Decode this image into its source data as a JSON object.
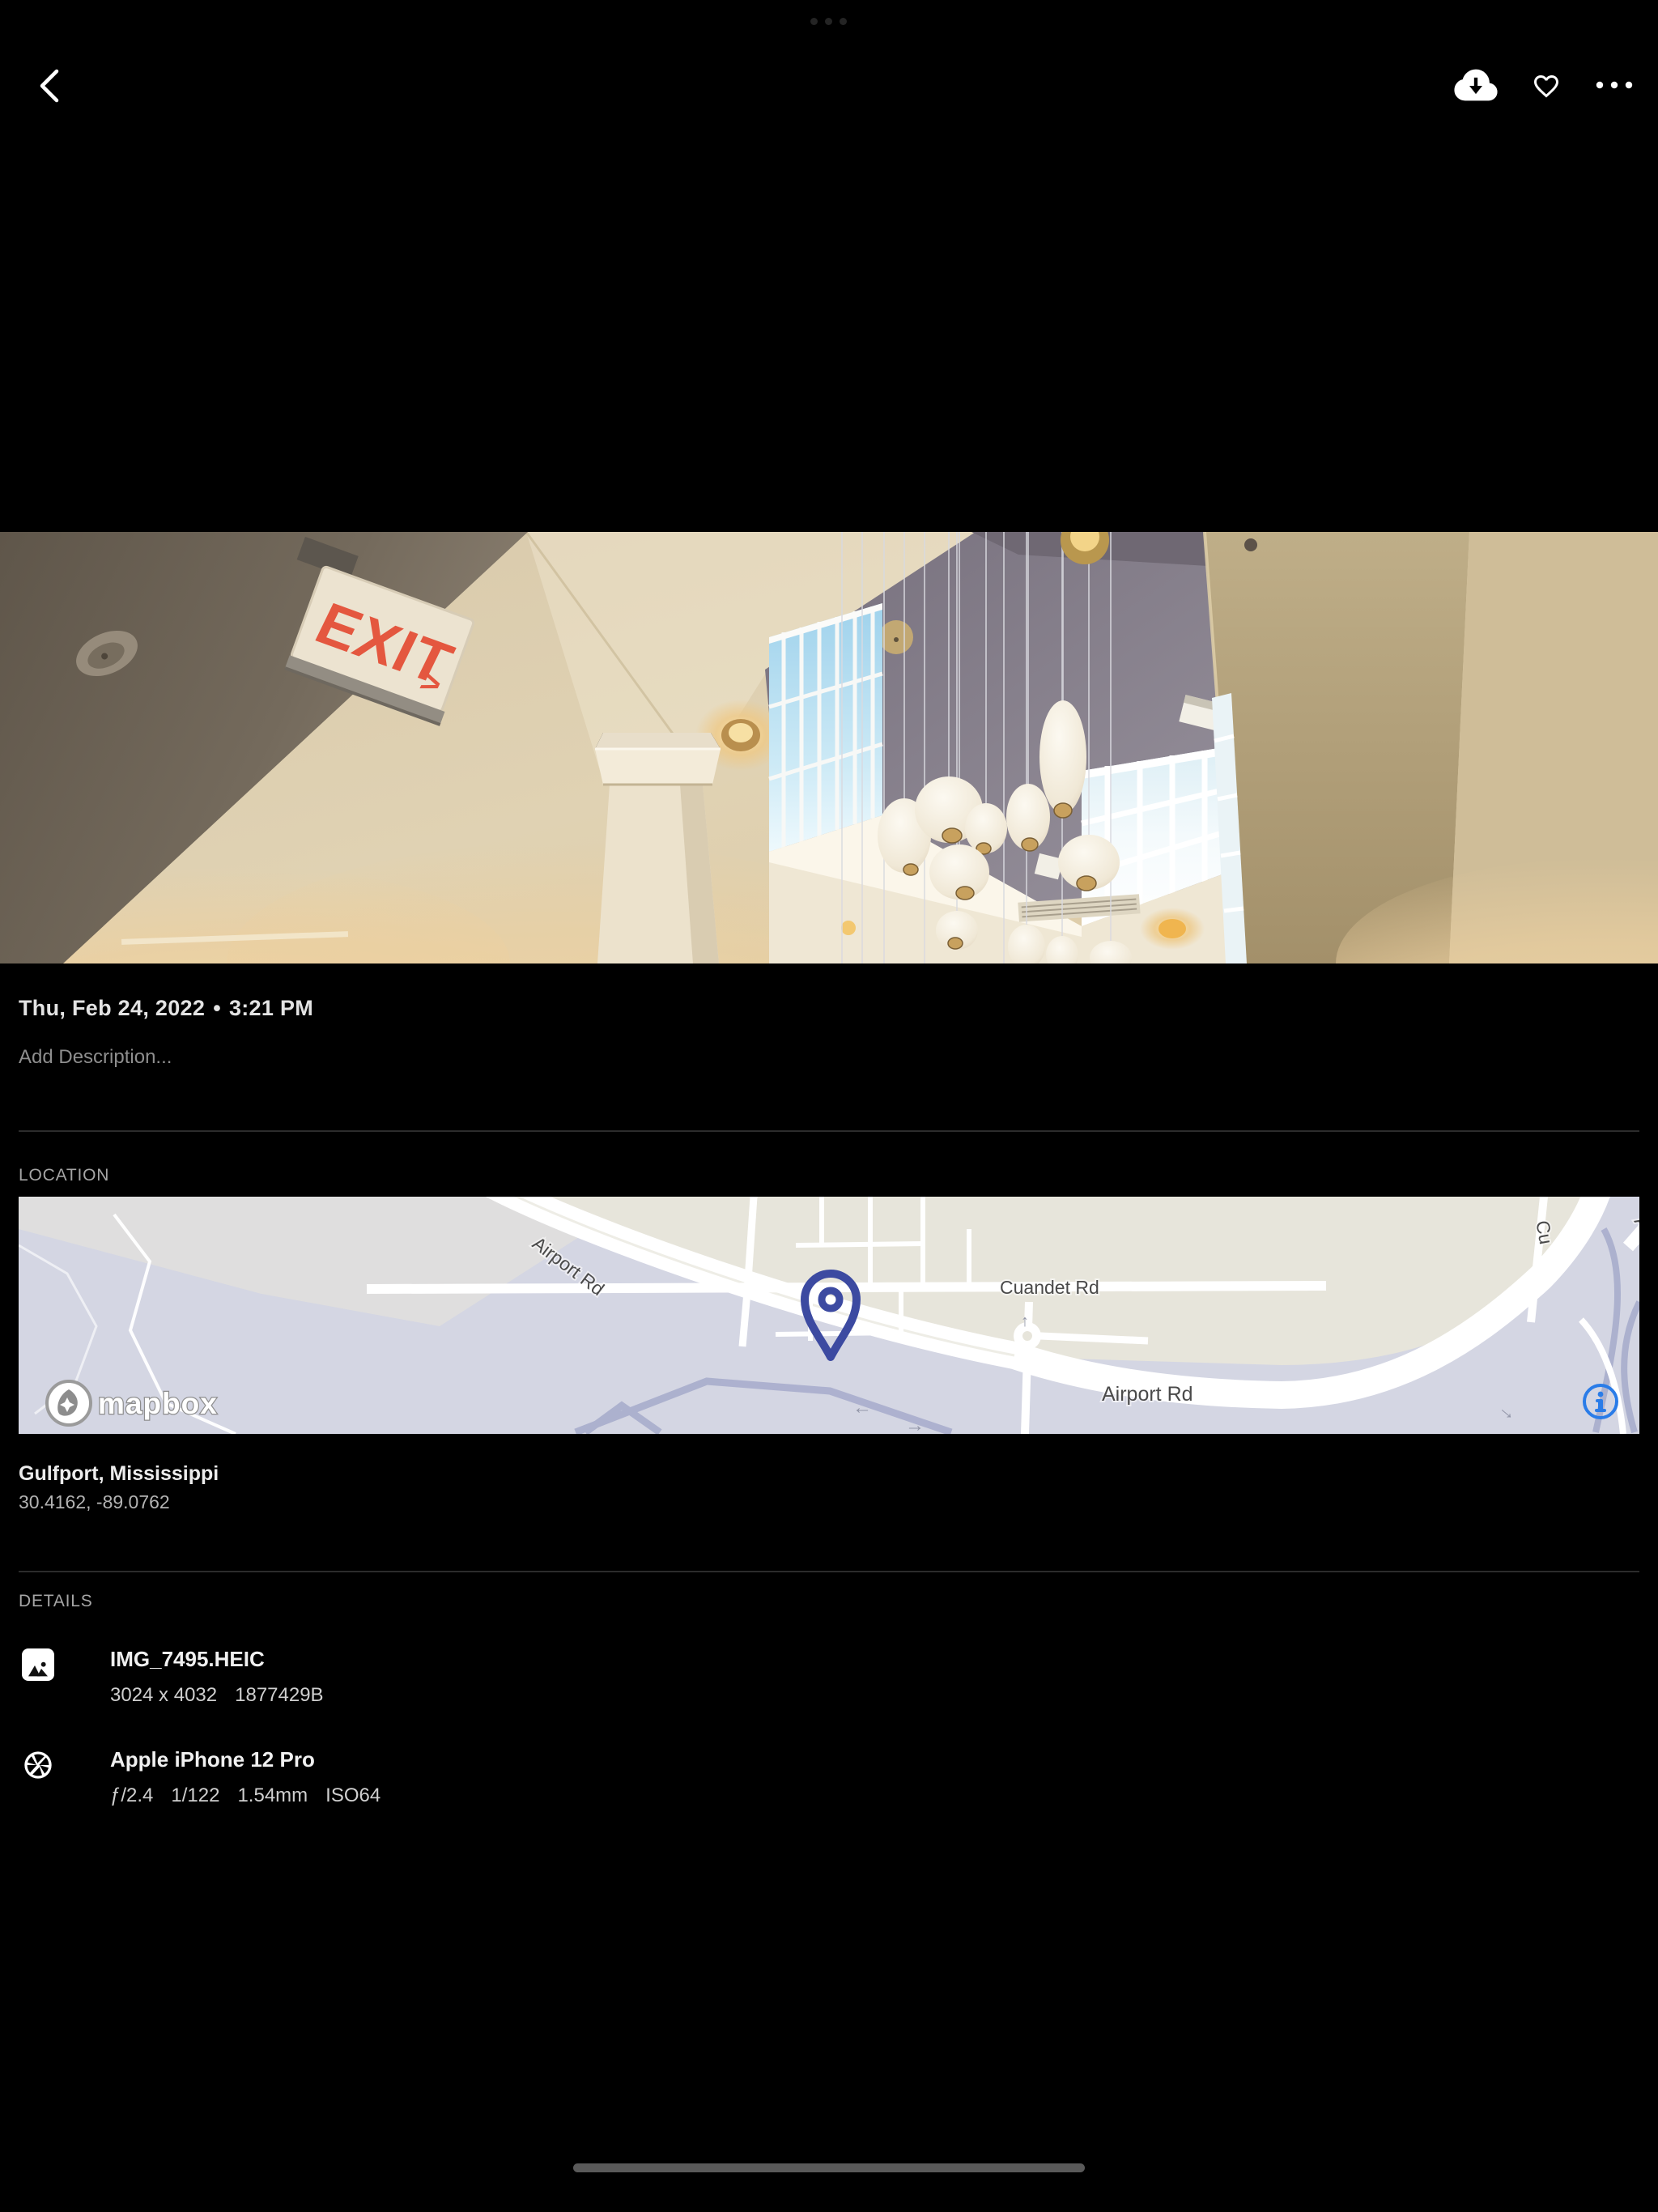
{
  "topbar": {
    "back_icon": "chevron-left",
    "actions": [
      {
        "label": "Download",
        "icon": "cloud-download-icon"
      },
      {
        "label": "Favorite",
        "icon": "heart-outline-icon"
      },
      {
        "label": "More",
        "icon": "ellipsis-icon"
      }
    ]
  },
  "photo": {
    "exit_sign_text": "EXIT",
    "exit_sign_arrow": ">"
  },
  "meta": {
    "date": "Thu, Feb 24, 2022",
    "separator": "•",
    "time": "3:21 PM",
    "description_placeholder": "Add Description..."
  },
  "location": {
    "section_title": "LOCATION",
    "place": "Gulfport, Mississippi",
    "coordinates": "30.4162, -89.0762",
    "map": {
      "labels": {
        "airport_rd_diagonal": "Airport Rd",
        "cuandet_rd": "Cuandet Rd",
        "airport_rd_horizontal": "Airport Rd",
        "airport_rd_top_right": "Airpo",
        "street_top_right": "Cu"
      },
      "attribution": "mapbox",
      "pin_color": "#3c4aa1",
      "info_accent": "#2a7ce8"
    }
  },
  "details": {
    "section_title": "DETAILS",
    "file": {
      "name": "IMG_7495.HEIC",
      "dimensions": "3024 x 4032",
      "size": "1877429B"
    },
    "camera": {
      "name": "Apple iPhone 12 Pro",
      "aperture": "ƒ/2.4",
      "shutter": "1/122",
      "focal_length": "1.54mm",
      "iso": "ISO64"
    }
  }
}
